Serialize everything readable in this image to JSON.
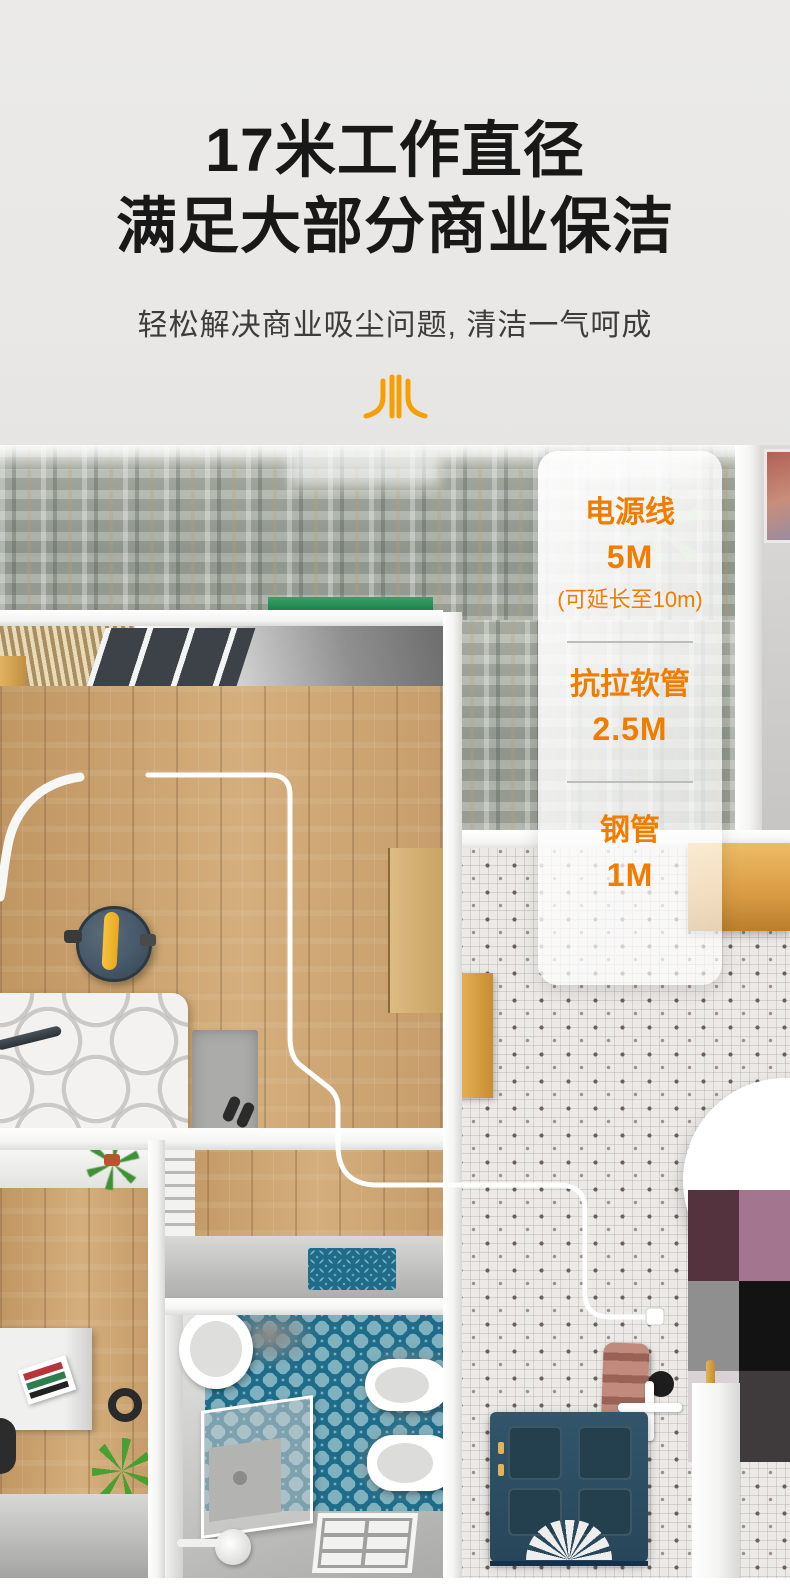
{
  "header": {
    "title_line1": "17米工作直径",
    "title_line2": "满足大部分商业保洁",
    "subtitle": "轻松解决商业吸尘问题, 清洁一气呵成"
  },
  "spec_panel": {
    "items": [
      {
        "label": "电源线",
        "value": "5M",
        "note": "(可延长至10m)"
      },
      {
        "label": "抗拉软管",
        "value": "2.5M"
      },
      {
        "label": "钢管",
        "value": "1M"
      }
    ]
  },
  "icons": {
    "logo": "four-stroke-brand-mark",
    "leaf_decoration": "green-leaf-star"
  },
  "colors": {
    "accent_orange": "#F07C00",
    "title_black": "#181818",
    "panel_divider": "#BDBDBD",
    "tile_teal": "#1E6C8A",
    "door_teal": "#2E4D60",
    "vacuum_body": "#46586A",
    "vacuum_handle": "#F2B32B"
  }
}
